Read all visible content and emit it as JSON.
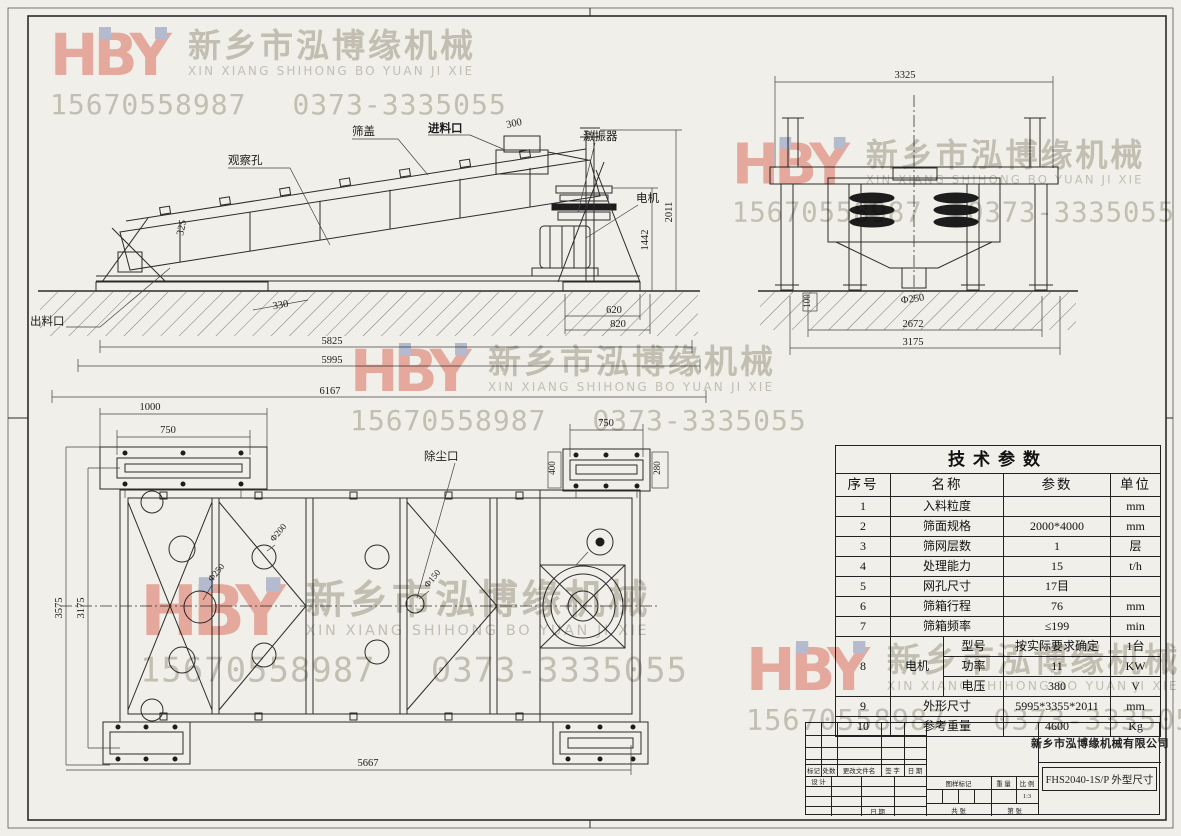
{
  "watermark": {
    "logo": "HBY",
    "company_cn": "新乡市泓博缘机械",
    "company_pinyin": "XIN XIANG SHIHONG BO YUAN JI XIE",
    "phone1": "15670558987",
    "phone2": "0373-3335055"
  },
  "side_view": {
    "labels": {
      "observation_hole": "观察孔",
      "screen_cover": "筛盖",
      "feed_inlet": "进料口",
      "exciter": "激振器",
      "motor": "电机",
      "discharge_port": "出料口"
    },
    "dims": {
      "feed_opening": "300",
      "total_height": "2011",
      "motor_height": "1442",
      "pad_offset": "330",
      "pad_width": "620",
      "pad_outer": "820",
      "span_inner": "5825",
      "span_outer": "5995",
      "span_total": "6167",
      "side_325": "325"
    }
  },
  "end_view": {
    "dims": {
      "width_top": "3325",
      "discharge_dia": "Φ250",
      "ground_100": "100",
      "leg_span_inner": "2672",
      "leg_span_outer": "3175"
    }
  },
  "plan_view": {
    "labels": {
      "dust_port": "除尘口"
    },
    "dims": {
      "pad_len": "1000",
      "bolt_span_left": "750",
      "bolt_span_right": "750",
      "pad_w_400": "400",
      "pad_w_280": "280",
      "width_outer": "3575",
      "width_inner": "3175",
      "length": "5667",
      "hole_250": "Φ250",
      "hole_200": "Φ200",
      "hole_150": "Φ150"
    }
  },
  "table": {
    "title": "技术参数",
    "headers": [
      "序号",
      "名称",
      "参数",
      "单位"
    ],
    "rows": [
      [
        "1",
        "入料粒度",
        "",
        "mm"
      ],
      [
        "2",
        "筛面规格",
        "2000*4000",
        "mm"
      ],
      [
        "3",
        "筛网层数",
        "1",
        "层"
      ],
      [
        "4",
        "处理能力",
        "15",
        "t/h"
      ],
      [
        "5",
        "网孔尺寸",
        "17目",
        ""
      ],
      [
        "6",
        "筛箱行程",
        "76",
        "mm"
      ],
      [
        "7",
        "筛箱频率",
        "≤199",
        "min"
      ]
    ],
    "motor_group": {
      "no": "8",
      "name": "电机",
      "subs": [
        [
          "型号",
          "按实际要求确定",
          "1台"
        ],
        [
          "功率",
          "11",
          "KW"
        ],
        [
          "电压",
          "380",
          "V"
        ]
      ]
    },
    "rows2": [
      [
        "9",
        "外形尺寸",
        "5995*3355*2011",
        "mm"
      ],
      [
        "10",
        "参考重量",
        "4600",
        "Kg"
      ]
    ]
  },
  "title_block": {
    "company": "新乡市泓博缘机械有限公司",
    "drawing_title": "FHS2040-1S/P  外型尺寸",
    "labels": {
      "mark": "标记",
      "qty": "处数",
      "change_file": "更改文件名",
      "sign": "签 字",
      "date": "日 期",
      "design": "设 计",
      "date2": "日 期",
      "stamp": "图样标记",
      "weight": "重 量",
      "scale": "比 例",
      "scale_value": "1:3",
      "total_sheets": "共  张",
      "sheet_number": "第  张"
    }
  }
}
